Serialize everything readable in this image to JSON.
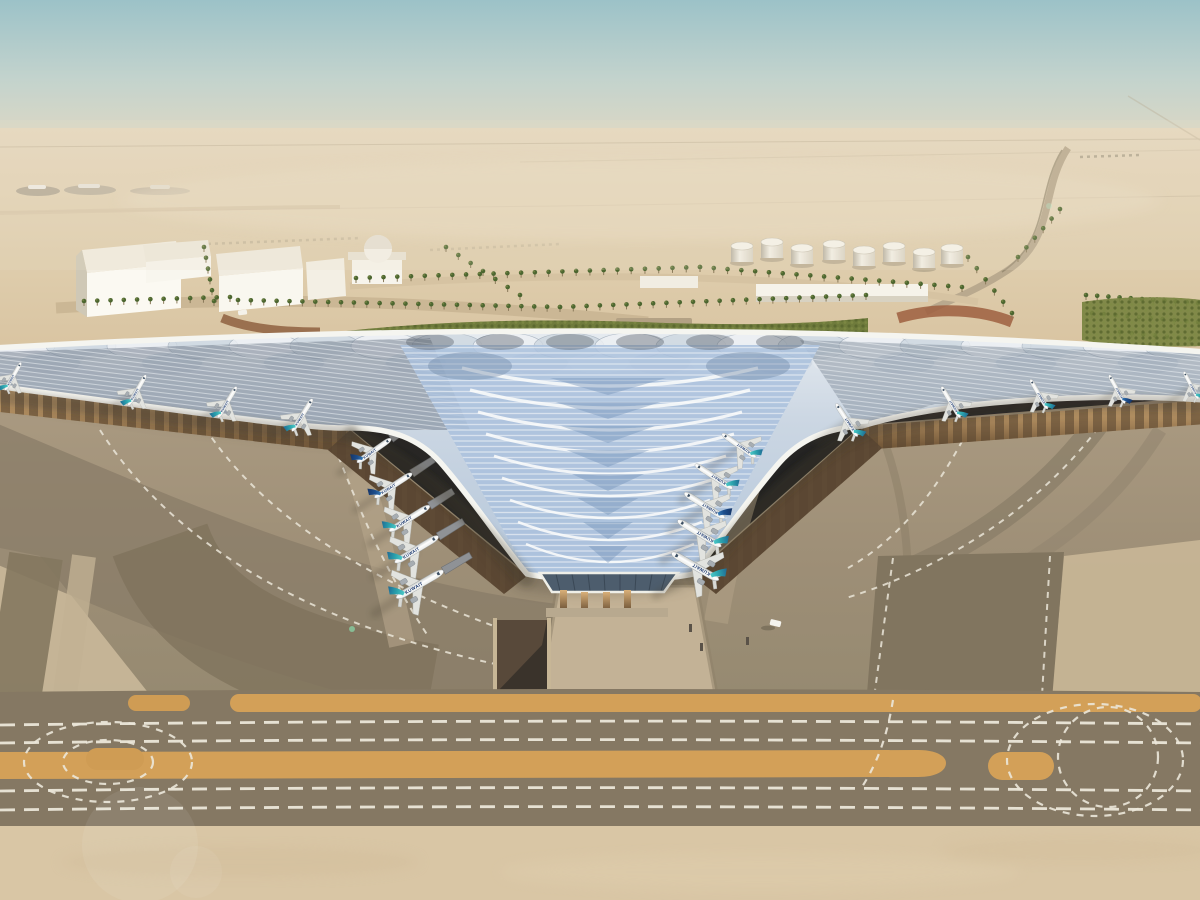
{
  "scene": {
    "title": "Aerial rendering of Kuwait International Airport trefoil terminal in desert landscape",
    "airline": {
      "title": "KUWAIT"
    },
    "colors": {
      "sky_top": "#9cc2c8",
      "sky_horizon": "#e6dac3",
      "desert": "#dcc8a8",
      "roof_panel": "#a8c0dc",
      "roof_rib": "#f3f5f6",
      "facade_gold": "#c49a63",
      "apron": "#9f9079",
      "taxiway": "#7e7260",
      "marking_orange": "#d3a058",
      "marking_white": "#ece7da",
      "fin_teal": "#35b5b8",
      "fin_navy": "#1d3f7e",
      "hedge_green": "#6f7b3c"
    },
    "counts": {
      "aircraft_visible": 19,
      "fuel_tanks": 8
    }
  },
  "planes": [
    {
      "x": 12,
      "y": 378,
      "r": 30,
      "s": 0.62,
      "fin": "teal",
      "m": 0,
      "b": 0
    },
    {
      "x": 136,
      "y": 392,
      "r": 30,
      "s": 0.68,
      "fin": "teal",
      "m": 0,
      "b": 0
    },
    {
      "x": 226,
      "y": 404,
      "r": 31,
      "s": 0.7,
      "fin": "teal",
      "m": 0,
      "b": 0
    },
    {
      "x": 301,
      "y": 417,
      "r": 32,
      "s": 0.74,
      "fin": "teal",
      "m": 0,
      "b": 0
    },
    {
      "x": 372,
      "y": 452,
      "r": 55,
      "s": 0.8,
      "fin": "navy",
      "m": 0,
      "b": 1
    },
    {
      "x": 391,
      "y": 487,
      "r": 57,
      "s": 0.86,
      "fin": "navy",
      "m": 0,
      "b": 1
    },
    {
      "x": 407,
      "y": 520,
      "r": 58,
      "s": 0.92,
      "fin": "teal",
      "m": 0,
      "b": 1
    },
    {
      "x": 414,
      "y": 551,
      "r": 59,
      "s": 0.98,
      "fin": "teal",
      "m": 0,
      "b": 1
    },
    {
      "x": 417,
      "y": 586,
      "r": 60,
      "s": 1.05,
      "fin": "teal",
      "m": 0,
      "b": 1
    },
    {
      "x": 741,
      "y": 447,
      "r": -55,
      "s": 0.8,
      "fin": "teal",
      "m": 1,
      "b": 1
    },
    {
      "x": 716,
      "y": 478,
      "r": -57,
      "s": 0.86,
      "fin": "teal",
      "m": 1,
      "b": 1
    },
    {
      "x": 707,
      "y": 507,
      "r": -58,
      "s": 0.92,
      "fin": "navy",
      "m": 1,
      "b": 1
    },
    {
      "x": 702,
      "y": 535,
      "r": -59,
      "s": 0.98,
      "fin": "teal",
      "m": 1,
      "b": 1
    },
    {
      "x": 698,
      "y": 568,
      "r": -60,
      "s": 1.05,
      "fin": "teal",
      "m": 1,
      "b": 1
    },
    {
      "x": 848,
      "y": 422,
      "r": -33,
      "s": 0.76,
      "fin": "teal",
      "m": 1,
      "b": 0
    },
    {
      "x": 952,
      "y": 404,
      "r": -31,
      "s": 0.7,
      "fin": "teal",
      "m": 1,
      "b": 0
    },
    {
      "x": 1040,
      "y": 396,
      "r": -30,
      "s": 0.66,
      "fin": "teal",
      "m": 1,
      "b": 0
    },
    {
      "x": 1118,
      "y": 391,
      "r": -29,
      "s": 0.63,
      "fin": "navy",
      "m": 1,
      "b": 0
    },
    {
      "x": 1192,
      "y": 387,
      "r": -28,
      "s": 0.6,
      "fin": "teal",
      "m": 1,
      "b": 0
    }
  ],
  "tanks": [
    {
      "x": 742,
      "y": 246
    },
    {
      "x": 772,
      "y": 242
    },
    {
      "x": 802,
      "y": 248
    },
    {
      "x": 834,
      "y": 244
    },
    {
      "x": 864,
      "y": 250
    },
    {
      "x": 894,
      "y": 246
    },
    {
      "x": 924,
      "y": 252
    },
    {
      "x": 952,
      "y": 248
    }
  ],
  "palm_rows": [
    {
      "x0": 238,
      "y0": 305,
      "x1": 560,
      "y1": 312,
      "n": 26
    },
    {
      "x0": 560,
      "y0": 312,
      "x1": 866,
      "y1": 300,
      "n": 24
    },
    {
      "x0": 356,
      "y0": 283,
      "x1": 700,
      "y1": 272,
      "n": 26
    },
    {
      "x0": 700,
      "y0": 272,
      "x1": 962,
      "y1": 292,
      "n": 20
    },
    {
      "x0": 204,
      "y0": 252,
      "x1": 214,
      "y1": 306,
      "n": 6
    },
    {
      "x0": 446,
      "y0": 252,
      "x1": 520,
      "y1": 300,
      "n": 7
    },
    {
      "x0": 968,
      "y0": 262,
      "x1": 1012,
      "y1": 318,
      "n": 6
    },
    {
      "x0": 1018,
      "y0": 262,
      "x1": 1060,
      "y1": 214,
      "n": 6
    },
    {
      "x0": 1086,
      "y0": 300,
      "x1": 1198,
      "y1": 308,
      "n": 11
    },
    {
      "x0": 1092,
      "y0": 318,
      "x1": 1198,
      "y1": 327,
      "n": 10
    },
    {
      "x0": 1120,
      "y0": 337,
      "x1": 1202,
      "y1": 345,
      "n": 8
    },
    {
      "x0": 84,
      "y0": 306,
      "x1": 230,
      "y1": 302,
      "n": 12
    }
  ],
  "roof_decor": {
    "chevrons": 9,
    "dark_triangles": 8,
    "scallops_top": 20
  }
}
